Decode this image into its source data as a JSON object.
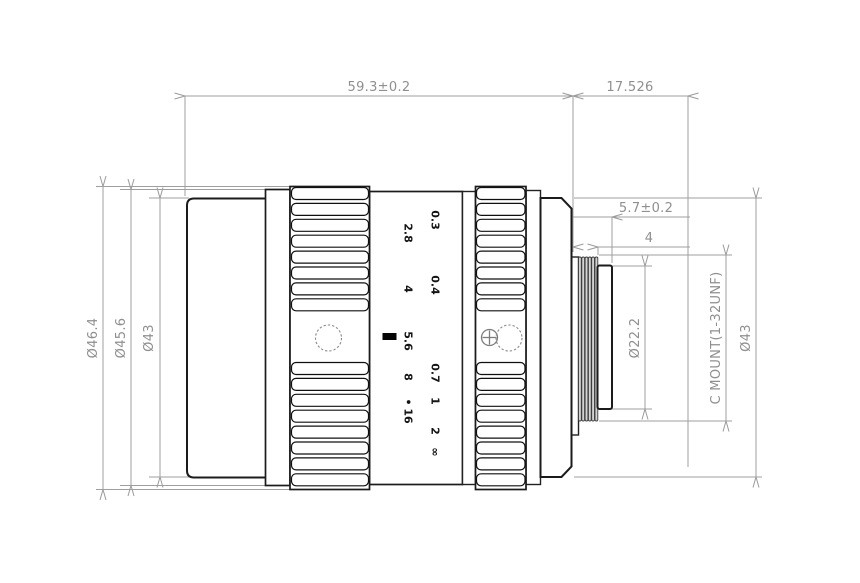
{
  "drawing": {
    "title": "C-mount lens outline drawing",
    "view": "side elevation with dimensions"
  },
  "dims": {
    "total_length": "59.3±0.2",
    "flange_distance": "17.526",
    "rear_protrusion": "5.7±0.2",
    "thread_length": "4",
    "dia_front_max": "Ø46.4",
    "dia_ring": "Ø45.6",
    "dia_front_barrel": "Ø43",
    "dia_pilot": "Ø22.2",
    "mount_spec": "C MOUNT(1-32UNF)",
    "dia_rear_body": "Ø43"
  },
  "scales": {
    "aperture": {
      "values": [
        "2.8",
        "4",
        "5.6",
        "8",
        "16"
      ],
      "dot": "•"
    },
    "focus": {
      "values": [
        "0.3",
        "0.4",
        "0.7",
        "1",
        "2",
        "∞"
      ]
    }
  },
  "colors": {
    "body_line": "#1b1b1b",
    "dim_line": "#9f9f9f",
    "dim_text": "#8f8f8f",
    "mark_text": "#141414",
    "background": "#ffffff"
  }
}
